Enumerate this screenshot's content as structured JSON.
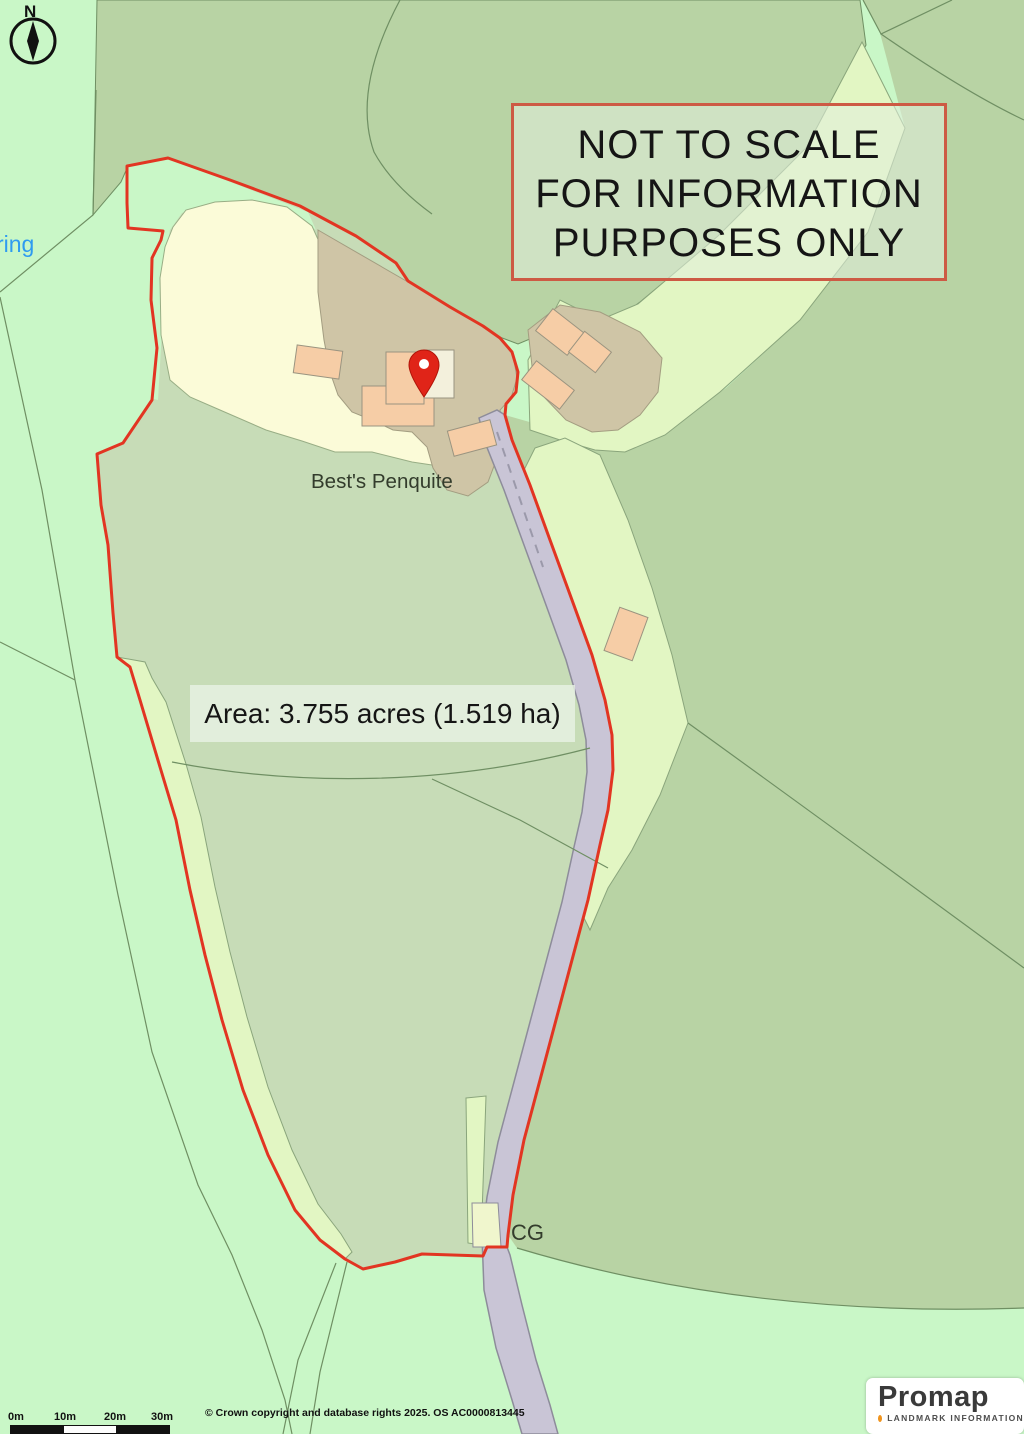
{
  "notice": {
    "lines": [
      "NOT TO SCALE",
      "FOR INFORMATION",
      "PURPOSES ONLY"
    ]
  },
  "labels": {
    "area": "Area: 3.755 acres (1.519 ha)",
    "place": "Best's Penquite",
    "cg": "CG",
    "partial_road_name": "ring",
    "compass_north": "N"
  },
  "scalebar": {
    "ticks": [
      "0m",
      "10m",
      "20m",
      "30m"
    ]
  },
  "attribution": {
    "copyright": "© Crown copyright and database rights 2025. OS AC0000813445"
  },
  "logo": {
    "brand": "Promap",
    "tagline": "LANDMARK INFORMATION"
  },
  "icons": {
    "compass": "north-compass-icon",
    "pin": "location-pin-icon"
  },
  "colors": {
    "background_mint": "#c9f7c7",
    "field_medium": "#b8d3a4",
    "parcel_sage": "#c7dcb7",
    "garden_cream": "#fbfbd8",
    "track_light": "#e2f6c3",
    "yard_tan": "#cfc5a6",
    "building_peach": "#f6cda6",
    "building_pale": "#f3f0dc",
    "road_fill": "#c9c5d6",
    "road_edge": "#8d8c9a",
    "boundary_red": "#e23522",
    "field_line": "#6f8f63",
    "notice_border": "#cd5a44",
    "notice_fill": "rgba(226,238,221,0.55)",
    "panel_fill": "rgba(233,243,229,0.8)",
    "text_dark": "#1c1c1c",
    "map_label": "#333c2c",
    "road_name_blue": "#2e9bf0",
    "logo_text": "#3a3a3a",
    "logo_dot_orange": "#f0941e",
    "pin_red": "#e02418"
  }
}
